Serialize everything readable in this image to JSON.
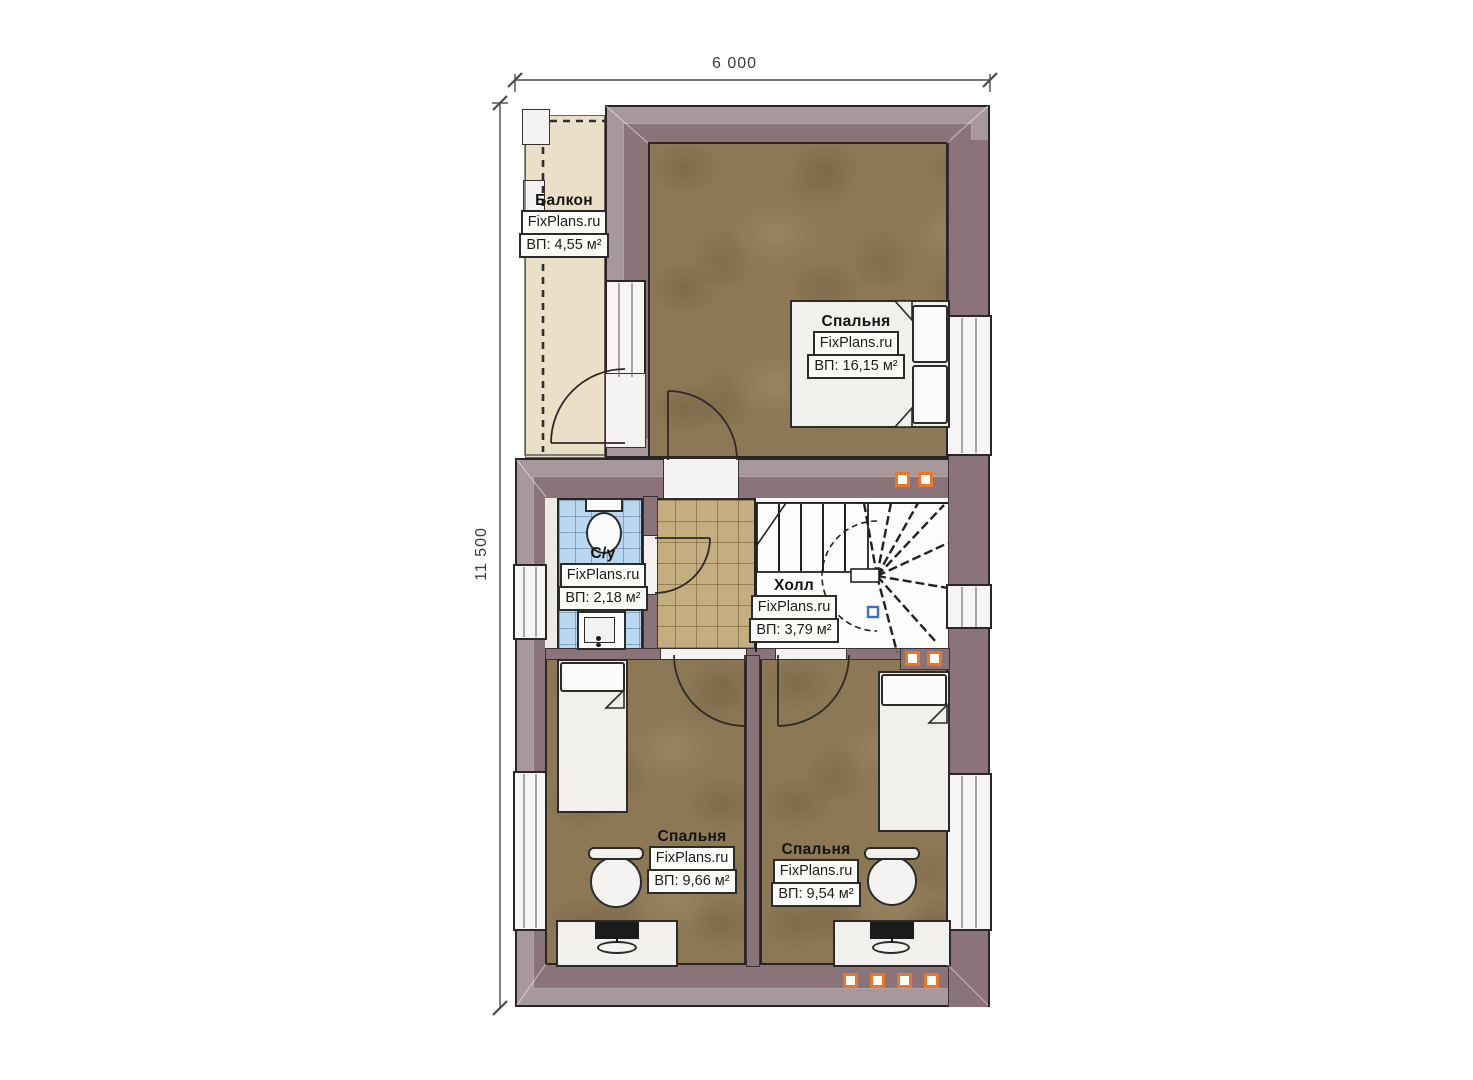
{
  "dimensions": {
    "top": "6 000",
    "left": "11 500"
  },
  "watermark_brand": "FixPlans.ru",
  "rooms": [
    {
      "key": "balcony",
      "name": "Балкон",
      "brand": "FixPlans.ru",
      "area": "ВП: 4,55 м²"
    },
    {
      "key": "bedroom-main",
      "name": "Спальня",
      "brand": "FixPlans.ru",
      "area": "ВП: 16,15 м²"
    },
    {
      "key": "bathroom",
      "name": "С/у",
      "brand": "FixPlans.ru",
      "area": "ВП: 2,18 м²"
    },
    {
      "key": "hall",
      "name": "Холл",
      "brand": "FixPlans.ru",
      "area": "ВП: 3,79 м²"
    },
    {
      "key": "bedroom-left",
      "name": "Спальня",
      "brand": "FixPlans.ru",
      "area": "ВП: 9,66 м²"
    },
    {
      "key": "bedroom-right",
      "name": "Спальня",
      "brand": "FixPlans.ru",
      "area": "ВП: 9,54 м²"
    }
  ],
  "colors": {
    "wall": "#8b737a",
    "wood_floor": "#8d7855",
    "hall_tile": "#c4ad7e",
    "bath_tile": "#b9d8ef",
    "balcony_floor": "#ebdfc8",
    "vent_orange": "#e8772a",
    "stair_node_blue": "#3f6fbf",
    "outline": "#2a2427"
  }
}
